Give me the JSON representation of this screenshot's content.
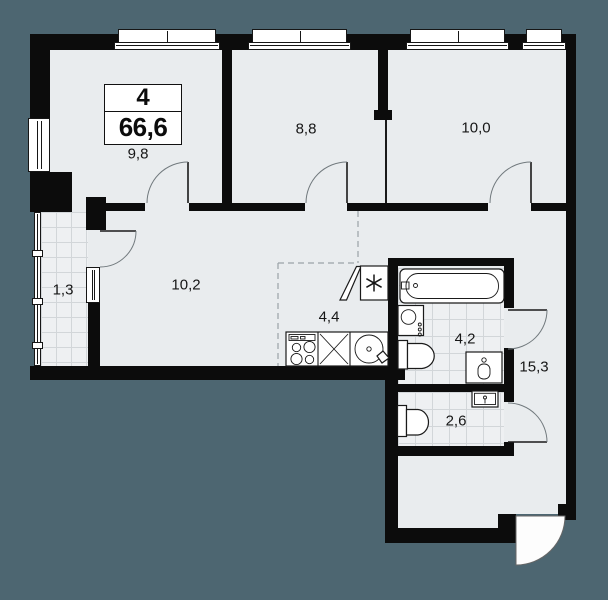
{
  "plan": {
    "type": "apartment-floor-plan",
    "summary": {
      "rooms_count": "4",
      "total_area_m2": "66,6"
    },
    "room_labels": {
      "bedroom_top_left": "9,8",
      "bedroom_top_middle": "8,8",
      "bedroom_top_right": "10,0",
      "balcony": "1,3",
      "living_hall": "10,2",
      "kitchen": "4,4",
      "bathroom": "4,2",
      "hallway": "15,3",
      "wc": "2,6"
    },
    "fixtures": [
      "bathtub",
      "bathroom-sink",
      "bathroom-toilet",
      "washing-machine",
      "wc-toilet",
      "wc-sink",
      "kitchen-stove",
      "kitchen-cabinet",
      "kitchen-sink",
      "ventilation-duct",
      "entrance-door"
    ],
    "colors": {
      "background": "#4d6671",
      "floor": "#e9ecee",
      "wall": "#0c0c0c",
      "tile_line": "#d2d6d9",
      "text": "#161616"
    }
  }
}
